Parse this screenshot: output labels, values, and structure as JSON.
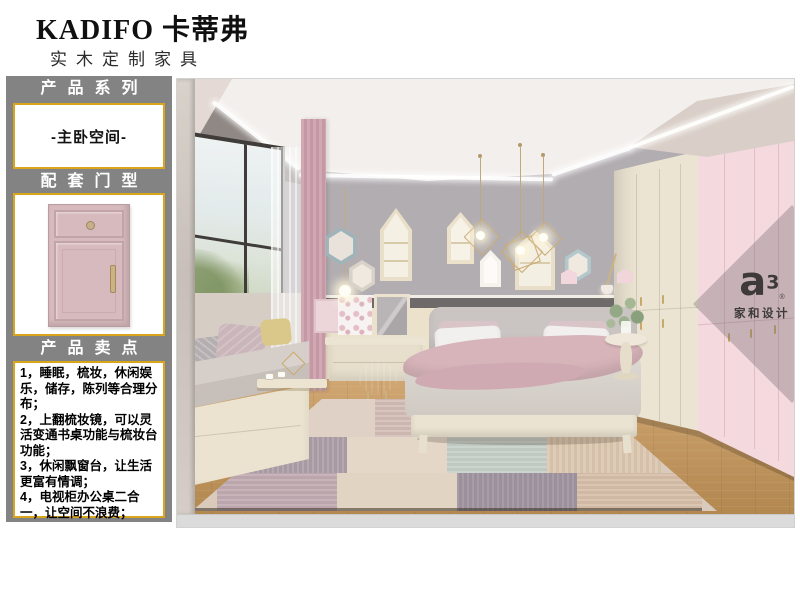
{
  "page": {
    "background": "#ffffff"
  },
  "header": {
    "brand": "KADIFO 卡蒂弗",
    "subtitle": "实木定制家具"
  },
  "sidebar": {
    "background": "#838383",
    "accent": "#d9a51d",
    "series": {
      "title": "产品系列",
      "value": "-主卧空间-"
    },
    "door_type": {
      "title": "配套门型",
      "image": "pink-cabinet-door-front"
    },
    "selling_points": {
      "title": "产品卖点",
      "items": [
        "1，睡眠，梳妆，休闲娱乐，储存，陈列等合理分布；",
        "2，上翻梳妆镜，可以灵活变通书桌功能与梳妆台功能；",
        "3，休闲飘窗台，让生活更富有情调；",
        "4，电视柜办公桌二合一，让空间不浪费；"
      ]
    }
  },
  "photo": {
    "subject": "pink-and-cream master bedroom interior render",
    "watermark": {
      "letter": "a",
      "superscript": "3",
      "registered": "®",
      "brand": "家和设计"
    }
  },
  "palette": {
    "door_pink": "#d7babd",
    "wardrobe_cream": "#ece4d2",
    "wardrobe_pink": "#f4d9de",
    "wall_gray": "#b2adb1",
    "floor_wood": "#c49a63"
  }
}
